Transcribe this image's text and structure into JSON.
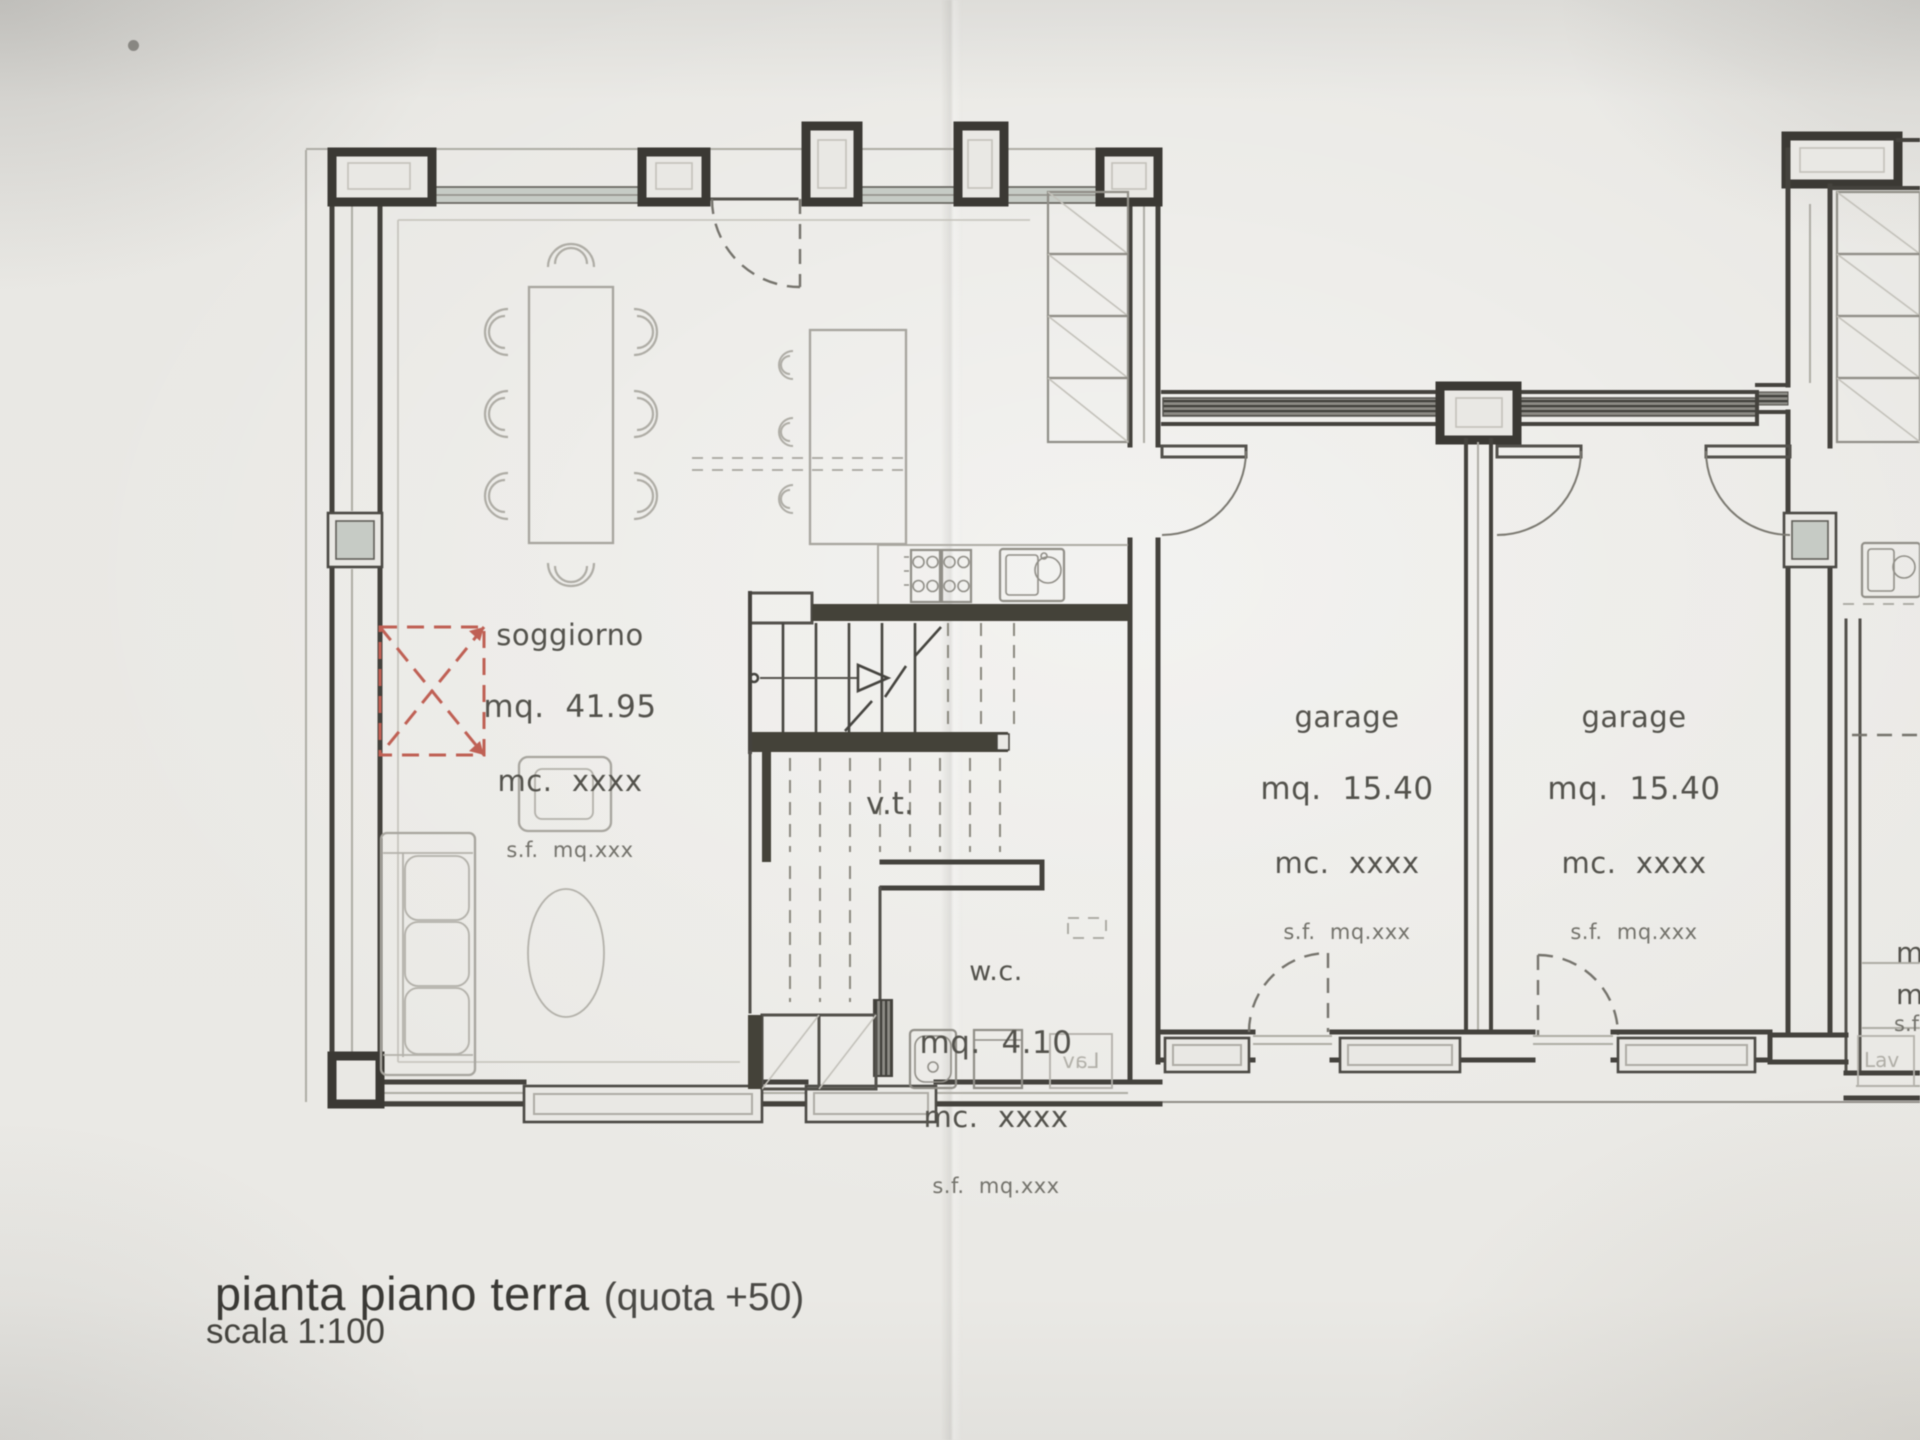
{
  "title_block": {
    "title": "pianta piano terra",
    "title_suffix": "(quota +50)",
    "scale": "scala 1:100"
  },
  "labels": {
    "soggiorno": {
      "name": "soggiorno",
      "area": "mq.  41.95",
      "volume": "mc.  xxxx",
      "surface": "s.f.  mq.xxx"
    },
    "garage_left": {
      "name": "garage",
      "area": "mq.  15.40",
      "volume": "mc.  xxxx",
      "surface": "s.f.  mq.xxx"
    },
    "garage_right": {
      "name": "garage",
      "area": "mq.  15.40",
      "volume": "mc.  xxxx",
      "surface": "s.f.  mq.xxx"
    },
    "wc": {
      "name": "w.c.",
      "area": "mq.  4.10",
      "volume": "mc.  xxxx",
      "surface": "s.f.  mq.xxx"
    },
    "stairwell": {
      "name": "v.t."
    },
    "laundry_mirrored": "Lav",
    "edge_fragments": {
      "line1": "m",
      "line2": "m",
      "line3": "s.f",
      "laundry": "Lav"
    }
  },
  "colors": {
    "paper": "#e8e7e3",
    "ink_dark": "#3e3d38",
    "ink_light": "#a9a8a2",
    "window_glass": "#c6cbc5",
    "demolition_red": "#bf6054",
    "text_dark": "#53524c",
    "text_light": "#8a8983"
  }
}
